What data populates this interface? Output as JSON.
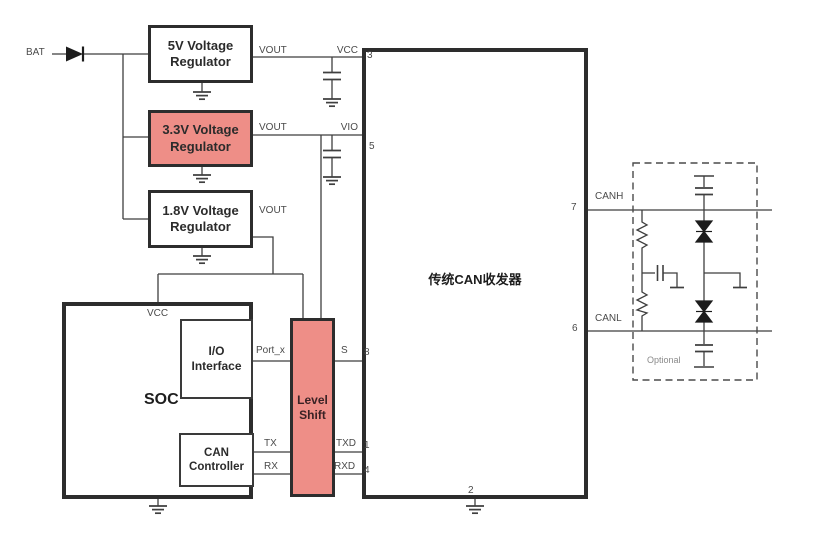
{
  "colors": {
    "highlight": "#ee8e87",
    "wire": "#3f3f3f",
    "box_border": "#2d2d2d",
    "label_text": "#4a4a4a"
  },
  "labels": {
    "bat": "BAT",
    "reg5": {
      "line1": "5V Voltage",
      "line2": "Regulator",
      "vout": "VOUT"
    },
    "reg33": {
      "line1": "3.3V Voltage",
      "line2": "Regulator",
      "vout": "VOUT"
    },
    "reg18": {
      "line1": "1.8V Voltage",
      "line2": "Regulator",
      "vout": "VOUT"
    },
    "soc": {
      "name": "SOC",
      "vcc": "VCC"
    },
    "io": {
      "line1": "I/O",
      "line2": "Interface"
    },
    "can": {
      "line1": "CAN",
      "line2": "Controller"
    },
    "level_shift": {
      "line1": "Level",
      "line2": "Shift"
    },
    "transceiver": {
      "title": "传统CAN收发器"
    },
    "pins": {
      "vcc": "VCC",
      "vio": "VIO",
      "s": "S",
      "txd": "TXD",
      "rxd": "RXD",
      "canh": "CANH",
      "canl": "CANL",
      "n1": "1",
      "n2": "2",
      "n3": "3",
      "n4": "4",
      "n5": "5",
      "n6": "6",
      "n7": "7",
      "n8": "8"
    },
    "signals": {
      "port_x": "Port_x",
      "tx": "TX",
      "rx": "RX"
    },
    "optional": "Optional"
  }
}
